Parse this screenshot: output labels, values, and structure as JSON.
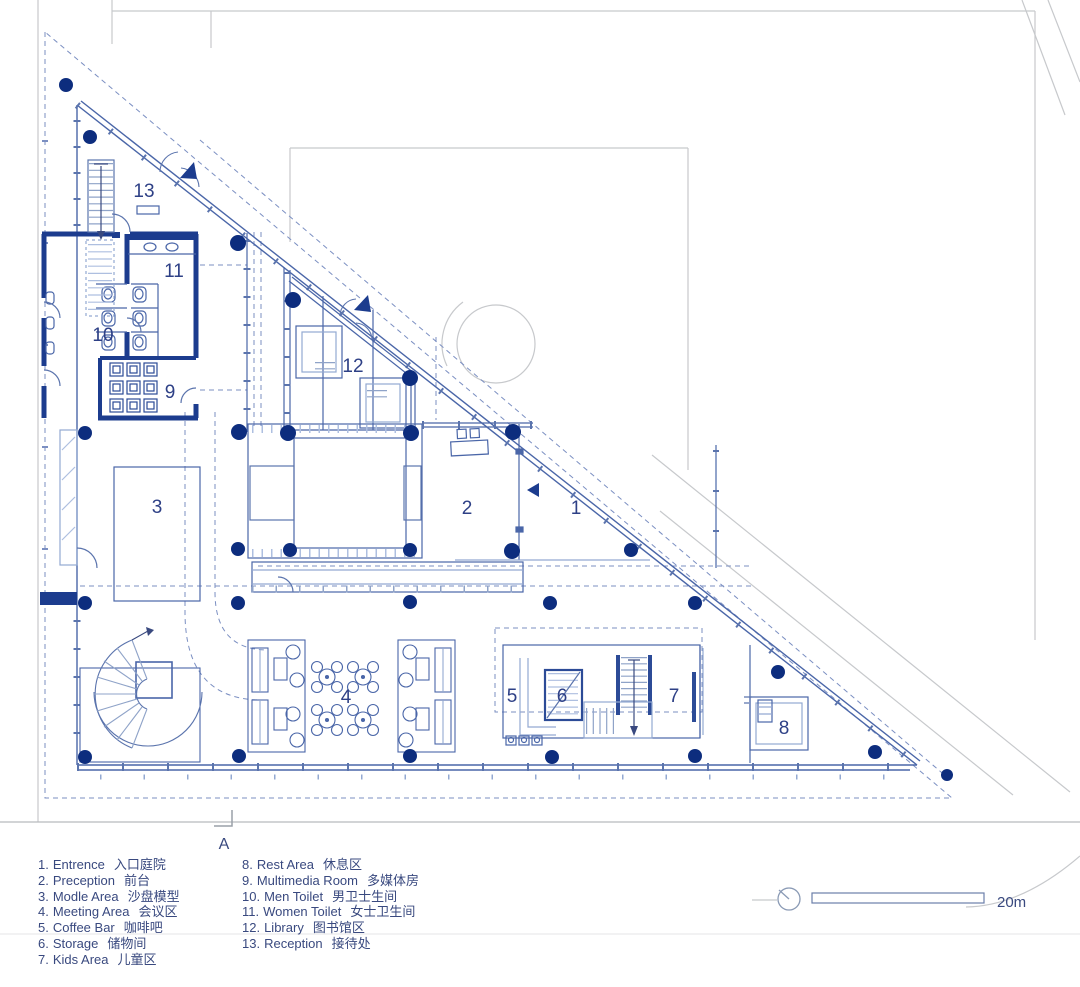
{
  "title": "First floor plan with room legend",
  "rooms": {
    "n1": "1",
    "n2": "2",
    "n3": "3",
    "n4": "4",
    "n5": "5",
    "n6": "6",
    "n7": "7",
    "n8": "8",
    "n9": "9",
    "n10": "10",
    "n11": "11",
    "n12": "12",
    "n13": "13"
  },
  "legend": {
    "col1": [
      {
        "n": "1.",
        "en": "Entrence",
        "zh": "入口庭院"
      },
      {
        "n": "2.",
        "en": "Preception",
        "zh": "前台"
      },
      {
        "n": "3.",
        "en": "Modle Area",
        "zh": "沙盘模型"
      },
      {
        "n": "4.",
        "en": "Meeting Area",
        "zh": "会议区"
      },
      {
        "n": "5.",
        "en": "Coffee Bar",
        "zh": "咖啡吧"
      },
      {
        "n": "6.",
        "en": "Storage",
        "zh": "储物间"
      },
      {
        "n": "7.",
        "en": "Kids Area",
        "zh": "儿童区"
      }
    ],
    "col2": [
      {
        "n": "8.",
        "en": "Rest Area",
        "zh": "休息区"
      },
      {
        "n": "9.",
        "en": "Multimedia Room",
        "zh": "多媒体房"
      },
      {
        "n": "10.",
        "en": "Men Toilet",
        "zh": "男卫士生间"
      },
      {
        "n": "11.",
        "en": "Women Toilet",
        "zh": "女士卫生间"
      },
      {
        "n": "12.",
        "en": "Library",
        "zh": "图书馆区"
      },
      {
        "n": "13.",
        "en": "Reception",
        "zh": "接待处"
      }
    ]
  },
  "scale_bar": {
    "label": "20m"
  },
  "section_marker": {
    "label": "A"
  },
  "colors": {
    "wall_navy": "#1c3c8e",
    "column_navy": "#0d2d7e",
    "line_blue": "#4a66a8",
    "light_blue": "#93a9d2",
    "dashed_blue": "#7b8fc2",
    "site_gray": "#c7c9cc",
    "text_blue": "#39497f"
  }
}
